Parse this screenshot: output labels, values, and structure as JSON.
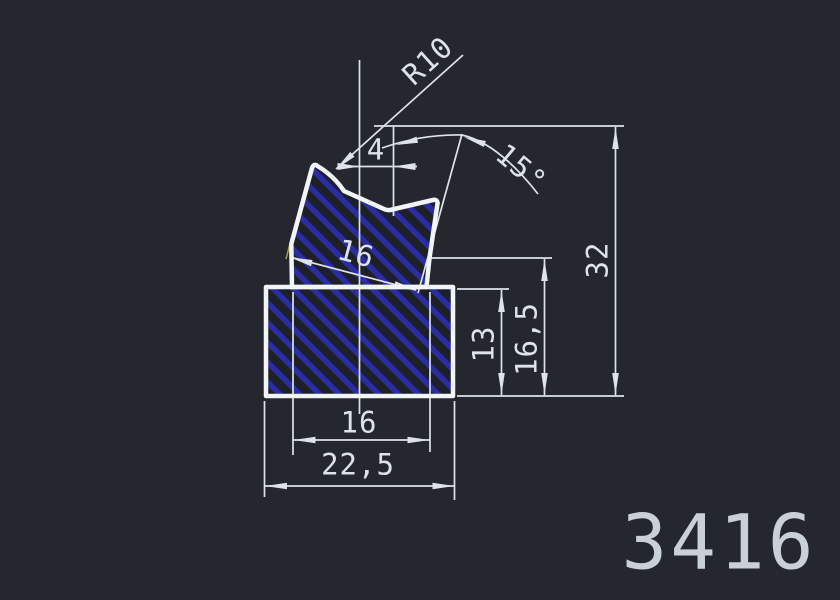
{
  "app": {
    "type": "cad-drawing-view"
  },
  "drawing": {
    "part_number": "3416",
    "labels": {
      "radius": "R10",
      "angle": "15°",
      "width_top": "4",
      "width_tilted": "16",
      "width_inner": "16",
      "width_total": "22,5",
      "height_base": "13",
      "height_mid": "16,5",
      "height_total": "32"
    },
    "colors": {
      "background": "#24282e",
      "outline": "#f2f5f8",
      "dimension": "#dde3e9",
      "hatch": "#2a2ca8",
      "part_number": "#c9d0d8",
      "extension_tick": "#9b9b45"
    }
  }
}
